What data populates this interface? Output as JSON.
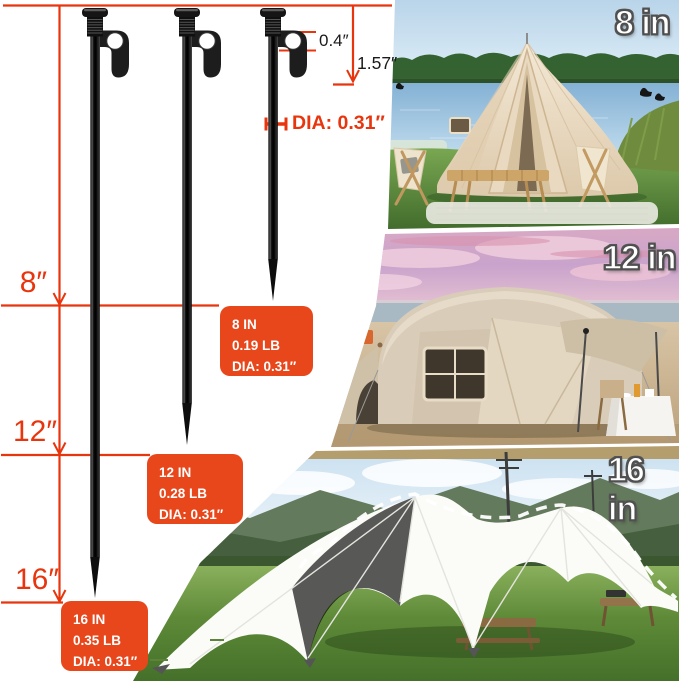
{
  "colors": {
    "annotation_red": "#e8350d",
    "spec_box_orange": "#e8471c"
  },
  "annotations": {
    "hook_hole_diameter": "0.4″",
    "head_length": "1.57″",
    "shaft_diameter": "DIA: 0.31″"
  },
  "rulers": {
    "sizes": [
      {
        "label": "8″"
      },
      {
        "label": "12″"
      },
      {
        "label": "16″"
      }
    ]
  },
  "spec_boxes": [
    {
      "length": "8 IN",
      "weight": "0.19 LB",
      "diameter": "DIA: 0.31″"
    },
    {
      "length": "12 IN",
      "weight": "0.28 LB",
      "diameter": "DIA: 0.31″"
    },
    {
      "length": "16 IN",
      "weight": "0.35 LB",
      "diameter": "DIA: 0.31″"
    }
  ],
  "photos": [
    {
      "label": "8 in"
    },
    {
      "label": "12 in"
    },
    {
      "label": "16 in"
    }
  ]
}
